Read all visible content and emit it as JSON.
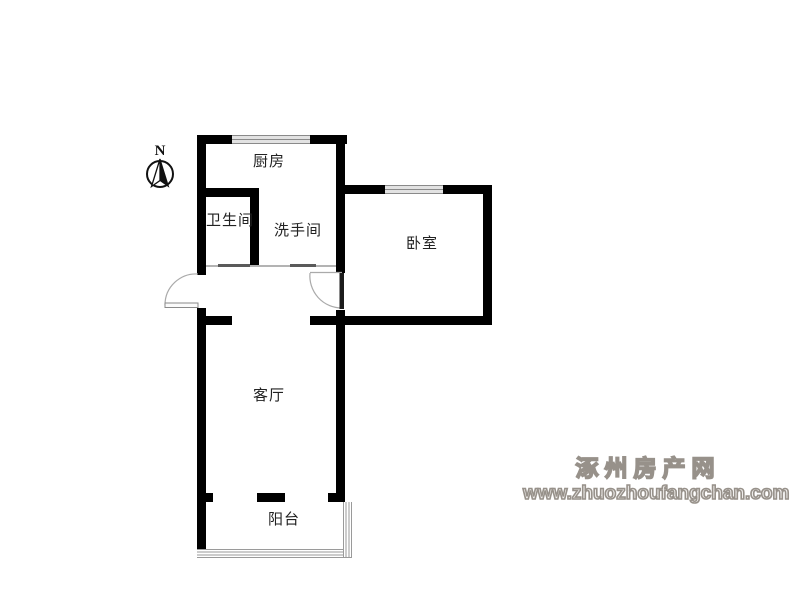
{
  "page": {
    "background": "#ffffff"
  },
  "compass": {
    "label": "N"
  },
  "floorplan": {
    "rooms": [
      {
        "name": "kitchen",
        "label": "厨房"
      },
      {
        "name": "bathroom",
        "label": "卫生间"
      },
      {
        "name": "washroom",
        "label": "洗手间"
      },
      {
        "name": "bedroom",
        "label": "卧室"
      },
      {
        "name": "living-room",
        "label": "客厅"
      },
      {
        "name": "balcony",
        "label": "阳台"
      }
    ]
  },
  "watermark": {
    "site_name": "涿州房产网",
    "site_url": "www.zhuozhoufangchan.com"
  },
  "colors": {
    "wall": "#000000",
    "window_frame": "#8a8a8a",
    "window_fill": "#e2e2e2",
    "door_arc": "#aaaaaa",
    "label": "#222222",
    "watermark": "#97918a"
  }
}
